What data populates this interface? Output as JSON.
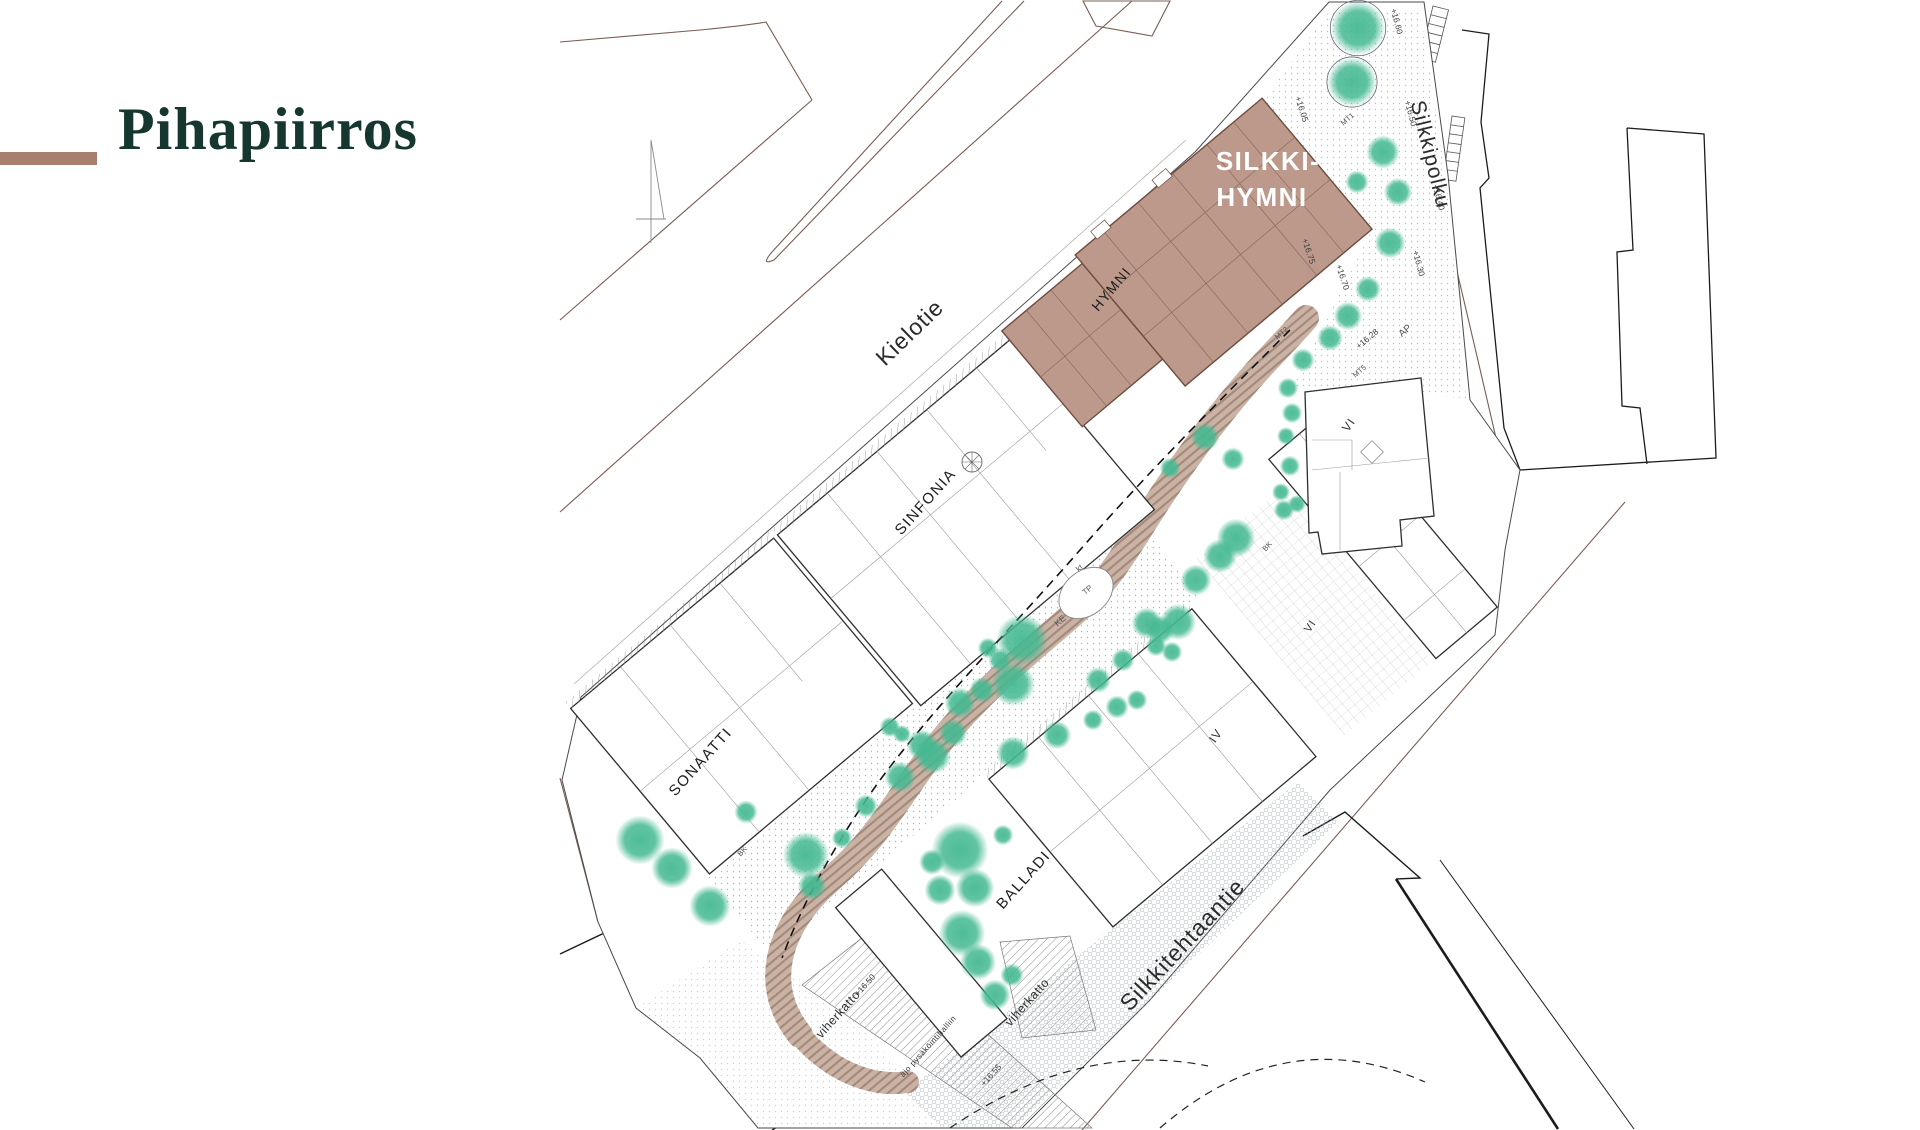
{
  "slide": {
    "title": "Pihapiirros"
  },
  "theme": {
    "background": "#ffffff",
    "title_color": "#15372f",
    "accent_color": "#a87e6c",
    "highlight_fill": "#bc998a",
    "highlight_stroke": "#6e4c3f",
    "tree_color": "#45b992",
    "path_fill": "#c9b3a5",
    "path_stripe": "#a5887a",
    "road_line": "#7a5c52",
    "building_stroke": "#2e2e2e",
    "label_color": "#1d1d1d"
  },
  "plan": {
    "streets": [
      {
        "id": "kielotie",
        "name": "Kielotie",
        "x": 915,
        "y": 338,
        "rot": -44,
        "size": 23
      },
      {
        "id": "silkkipolku",
        "name": "Silkkipolku",
        "x": 1424,
        "y": 156,
        "rot": 76,
        "size": 21
      },
      {
        "id": "silkkitehtaantie",
        "name": "Silkkitehtaantie",
        "x": 1188,
        "y": 950,
        "rot": -47,
        "size": 23
      }
    ],
    "buildings": [
      {
        "id": "silkki-hymni",
        "name": "SILKKI-HYMNI",
        "highlight": true,
        "label_color": "#ffffff",
        "bold": true,
        "label_lines": [
          {
            "text": "SILKKI-",
            "x": 1268,
            "y": 170,
            "rot": 0,
            "size": 26
          },
          {
            "text": "HYMNI",
            "x": 1262,
            "y": 206,
            "rot": 0,
            "size": 26
          }
        ]
      },
      {
        "id": "hymni",
        "name": "HYMNI",
        "label_color": "#1d1d1d",
        "label_lines": [
          {
            "text": "HYMNI",
            "x": 1115,
            "y": 292,
            "rot": -50,
            "size": 14
          }
        ]
      },
      {
        "id": "sinfonia",
        "name": "SINFONIA",
        "label_color": "#1d1d1d",
        "label_lines": [
          {
            "text": "SINFONIA",
            "x": 929,
            "y": 505,
            "rot": -48,
            "size": 15
          }
        ]
      },
      {
        "id": "sonaatti",
        "name": "SONAATTI",
        "label_color": "#1d1d1d",
        "label_lines": [
          {
            "text": "SONAATTI",
            "x": 704,
            "y": 765,
            "rot": -48,
            "size": 15
          }
        ]
      },
      {
        "id": "balladi",
        "name": "BALLADI",
        "label_color": "#1d1d1d",
        "label_lines": [
          {
            "text": "BALLADI",
            "x": 1027,
            "y": 883,
            "rot": -48,
            "size": 15
          }
        ]
      }
    ],
    "floor_markers": [
      {
        "text": "VI",
        "x": 1352,
        "y": 427,
        "rot": -55,
        "size": 12
      },
      {
        "text": "VI",
        "x": 1313,
        "y": 628,
        "rot": -55,
        "size": 11
      },
      {
        "text": "IV",
        "x": 1219,
        "y": 738,
        "rot": -55,
        "size": 12
      }
    ],
    "area_labels": [
      {
        "text": "viherkatto",
        "x": 841,
        "y": 1017,
        "rot": -48,
        "size": 12.5
      },
      {
        "text": "viherkatto",
        "x": 1030,
        "y": 1005,
        "rot": -48,
        "size": 12.5
      },
      {
        "text": "ajo pysäköintihalliin",
        "x": 930,
        "y": 1048,
        "rot": -48,
        "size": 8
      }
    ],
    "elevation_labels": [
      {
        "text": "+16.60",
        "x": 1394,
        "y": 22,
        "rot": 75
      },
      {
        "text": "+16.50",
        "x": 1408,
        "y": 114,
        "rot": 75
      },
      {
        "text": "+16.40",
        "x": 1436,
        "y": 198,
        "rot": 75
      },
      {
        "text": "+16.30",
        "x": 1416,
        "y": 264,
        "rot": 75
      },
      {
        "text": "+16.05",
        "x": 1299,
        "y": 110,
        "rot": 72
      },
      {
        "text": "+16.75",
        "x": 1306,
        "y": 252,
        "rot": 72
      },
      {
        "text": "+16.70",
        "x": 1340,
        "y": 278,
        "rot": 72
      },
      {
        "text": "+16.28",
        "x": 1369,
        "y": 341,
        "rot": -40
      },
      {
        "text": "+16.50",
        "x": 867,
        "y": 987,
        "rot": -48
      },
      {
        "text": "+16.55",
        "x": 993,
        "y": 1077,
        "rot": -48
      }
    ],
    "code_labels": [
      {
        "text": "MT1",
        "x": 1349,
        "y": 121,
        "rot": -40,
        "size": 7.5
      },
      {
        "text": "MT2",
        "x": 1283,
        "y": 335,
        "rot": -40,
        "size": 7.5
      },
      {
        "text": "MT5",
        "x": 1361,
        "y": 373,
        "rot": -40,
        "size": 7.5
      },
      {
        "text": "AP",
        "x": 1407,
        "y": 333,
        "rot": -40,
        "size": 10
      },
      {
        "text": "KE",
        "x": 1062,
        "y": 623,
        "rot": -40,
        "size": 9
      },
      {
        "text": "TP",
        "x": 1089,
        "y": 592,
        "rot": -40,
        "size": 8
      },
      {
        "text": "kt",
        "x": 1081,
        "y": 570,
        "rot": -40,
        "size": 8
      },
      {
        "text": "BK",
        "x": 744,
        "y": 853,
        "rot": -48,
        "size": 7.5
      },
      {
        "text": "BK",
        "x": 1269,
        "y": 548,
        "rot": -48,
        "size": 7.5
      }
    ],
    "trees": [
      {
        "x": 1358,
        "y": 28,
        "r": 21,
        "ring": true
      },
      {
        "x": 1352,
        "y": 82,
        "r": 19,
        "ring": true
      },
      {
        "x": 1383,
        "y": 152,
        "r": 13
      },
      {
        "x": 1357,
        "y": 182,
        "r": 9
      },
      {
        "x": 1398,
        "y": 192,
        "r": 11
      },
      {
        "x": 1390,
        "y": 243,
        "r": 12
      },
      {
        "x": 1368,
        "y": 289,
        "r": 10
      },
      {
        "x": 1348,
        "y": 316,
        "r": 11
      },
      {
        "x": 1330,
        "y": 338,
        "r": 10
      },
      {
        "x": 1303,
        "y": 360,
        "r": 9
      },
      {
        "x": 1288,
        "y": 388,
        "r": 8
      },
      {
        "x": 1292,
        "y": 413,
        "r": 8
      },
      {
        "x": 1286,
        "y": 436,
        "r": 7
      },
      {
        "x": 1290,
        "y": 466,
        "r": 8
      },
      {
        "x": 1281,
        "y": 492,
        "r": 7
      },
      {
        "x": 1205,
        "y": 437,
        "r": 11
      },
      {
        "x": 1233,
        "y": 459,
        "r": 9
      },
      {
        "x": 1170,
        "y": 468,
        "r": 8
      },
      {
        "x": 1236,
        "y": 538,
        "r": 15
      },
      {
        "x": 1220,
        "y": 556,
        "r": 13
      },
      {
        "x": 1196,
        "y": 580,
        "r": 12
      },
      {
        "x": 1284,
        "y": 510,
        "r": 8
      },
      {
        "x": 1297,
        "y": 504,
        "r": 7
      },
      {
        "x": 1178,
        "y": 622,
        "r": 14
      },
      {
        "x": 1160,
        "y": 630,
        "r": 11
      },
      {
        "x": 1172,
        "y": 652,
        "r": 8
      },
      {
        "x": 1156,
        "y": 646,
        "r": 8
      },
      {
        "x": 1147,
        "y": 623,
        "r": 12
      },
      {
        "x": 1123,
        "y": 660,
        "r": 9
      },
      {
        "x": 1098,
        "y": 680,
        "r": 10
      },
      {
        "x": 1137,
        "y": 700,
        "r": 8
      },
      {
        "x": 1117,
        "y": 707,
        "r": 9
      },
      {
        "x": 1093,
        "y": 720,
        "r": 8
      },
      {
        "x": 1022,
        "y": 640,
        "r": 20
      },
      {
        "x": 1013,
        "y": 684,
        "r": 17
      },
      {
        "x": 988,
        "y": 648,
        "r": 8
      },
      {
        "x": 1000,
        "y": 660,
        "r": 9
      },
      {
        "x": 982,
        "y": 690,
        "r": 10
      },
      {
        "x": 960,
        "y": 703,
        "r": 12
      },
      {
        "x": 953,
        "y": 733,
        "r": 11
      },
      {
        "x": 933,
        "y": 756,
        "r": 14
      },
      {
        "x": 922,
        "y": 745,
        "r": 12
      },
      {
        "x": 902,
        "y": 734,
        "r": 7
      },
      {
        "x": 890,
        "y": 727,
        "r": 8
      },
      {
        "x": 900,
        "y": 777,
        "r": 12
      },
      {
        "x": 1013,
        "y": 753,
        "r": 13
      },
      {
        "x": 1057,
        "y": 735,
        "r": 11
      },
      {
        "x": 866,
        "y": 806,
        "r": 9
      },
      {
        "x": 842,
        "y": 838,
        "r": 8
      },
      {
        "x": 960,
        "y": 850,
        "r": 22
      },
      {
        "x": 975,
        "y": 888,
        "r": 15
      },
      {
        "x": 940,
        "y": 890,
        "r": 12
      },
      {
        "x": 1003,
        "y": 835,
        "r": 8
      },
      {
        "x": 932,
        "y": 862,
        "r": 10
      },
      {
        "x": 962,
        "y": 933,
        "r": 18
      },
      {
        "x": 978,
        "y": 962,
        "r": 14
      },
      {
        "x": 995,
        "y": 995,
        "r": 12
      },
      {
        "x": 1012,
        "y": 975,
        "r": 9
      },
      {
        "x": 640,
        "y": 840,
        "r": 19
      },
      {
        "x": 672,
        "y": 868,
        "r": 16
      },
      {
        "x": 710,
        "y": 906,
        "r": 16
      },
      {
        "x": 806,
        "y": 855,
        "r": 18
      },
      {
        "x": 812,
        "y": 886,
        "r": 11
      },
      {
        "x": 746,
        "y": 812,
        "r": 9
      }
    ]
  }
}
